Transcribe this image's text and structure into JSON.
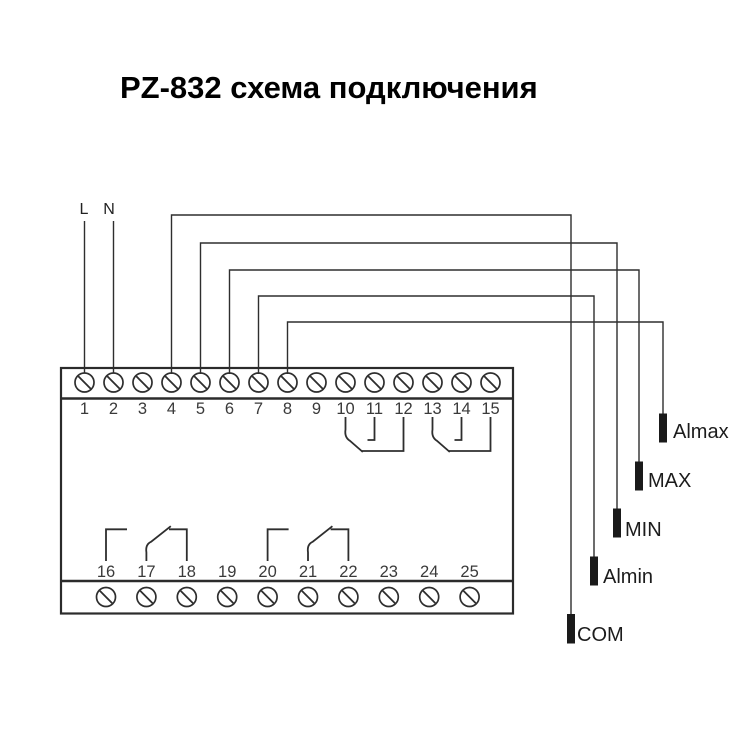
{
  "title": "PZ-832 схема подключения",
  "power": {
    "line_label": "L",
    "neutral_label": "N"
  },
  "device": {
    "top_terminals": [
      "1",
      "2",
      "3",
      "4",
      "5",
      "6",
      "7",
      "8",
      "9",
      "10",
      "11",
      "12",
      "13",
      "14",
      "15"
    ],
    "bottom_terminals": [
      "16",
      "17",
      "18",
      "19",
      "20",
      "21",
      "22",
      "23",
      "24",
      "25"
    ],
    "relay_contact_groups": [
      [
        "10",
        "11",
        "12"
      ],
      [
        "13",
        "14",
        "15"
      ],
      [
        "16",
        "17",
        "18"
      ],
      [
        "20",
        "21",
        "22"
      ]
    ]
  },
  "electrodes": [
    {
      "label": "Almax",
      "connected_terminal": "8"
    },
    {
      "label": "MAX",
      "connected_terminal": "6"
    },
    {
      "label": "MIN",
      "connected_terminal": "5"
    },
    {
      "label": "Almin",
      "connected_terminal": "7"
    },
    {
      "label": "COM",
      "connected_terminal": "4"
    }
  ],
  "colors": {
    "background": "#ffffff",
    "line": "#2e2e2e",
    "text": "#1c1c1c",
    "title": "#000000"
  }
}
